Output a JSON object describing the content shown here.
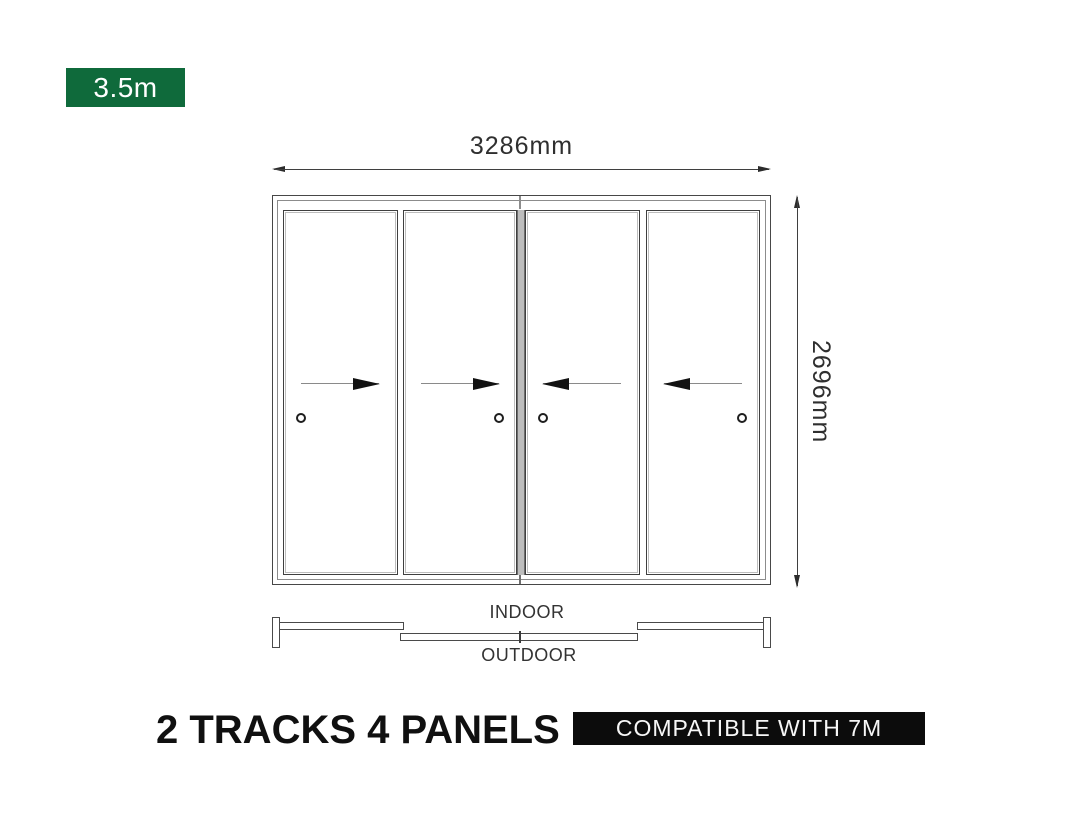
{
  "size_badge": {
    "label": "3.5m"
  },
  "dimensions": {
    "width": "3286mm",
    "height": "2696mm"
  },
  "door": {
    "panels": [
      {
        "name": "door-panel-1",
        "slide_direction": "right",
        "handle_side": "left"
      },
      {
        "name": "door-panel-2",
        "slide_direction": "right",
        "handle_side": "right"
      },
      {
        "name": "door-panel-3",
        "slide_direction": "left",
        "handle_side": "left"
      },
      {
        "name": "door-panel-4",
        "slide_direction": "left",
        "handle_side": "right"
      }
    ]
  },
  "plan_view": {
    "indoor_label": "INDOOR",
    "outdoor_label": "OUTDOOR"
  },
  "footer": {
    "title": "2 TRACKS 4 PANELS",
    "compatibility_label": "COMPATIBLE WITH 7M"
  },
  "colors": {
    "badge_green": "#0f6a3b",
    "badge_black": "#0c0c0c",
    "line": "#3f3f3f"
  }
}
